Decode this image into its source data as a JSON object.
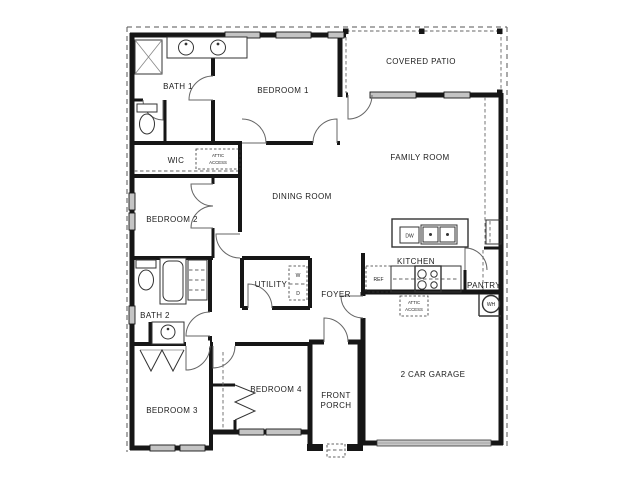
{
  "rooms": {
    "bath1": "BATH 1",
    "bedroom1": "BEDROOM 1",
    "covered_patio": "COVERED PATIO",
    "family_room": "FAMILY ROOM",
    "wic": "WIC",
    "dining_room": "DINING ROOM",
    "bedroom2": "BEDROOM 2",
    "kitchen": "KITCHEN",
    "utility": "UTILITY",
    "foyer": "FOYER",
    "pantry": "PANTRY",
    "bath2": "BATH 2",
    "garage": "2 CAR GARAGE",
    "bedroom3": "BEDROOM 3",
    "bedroom4": "BEDROOM 4"
  },
  "porch": {
    "line1": "FRONT",
    "line2": "PORCH"
  },
  "attic": {
    "line1": "ATTIC",
    "line2": "ACCESS"
  },
  "appliances": {
    "dishwasher": "DW",
    "refrigerator": "REF",
    "water_heater": "WH",
    "washer": "W",
    "dryer": "D"
  },
  "colors": {
    "wall": "#161616",
    "window_fill": "#c4c4c4",
    "garage_door_fill": "#c8c8c8",
    "background": "#ffffff"
  }
}
